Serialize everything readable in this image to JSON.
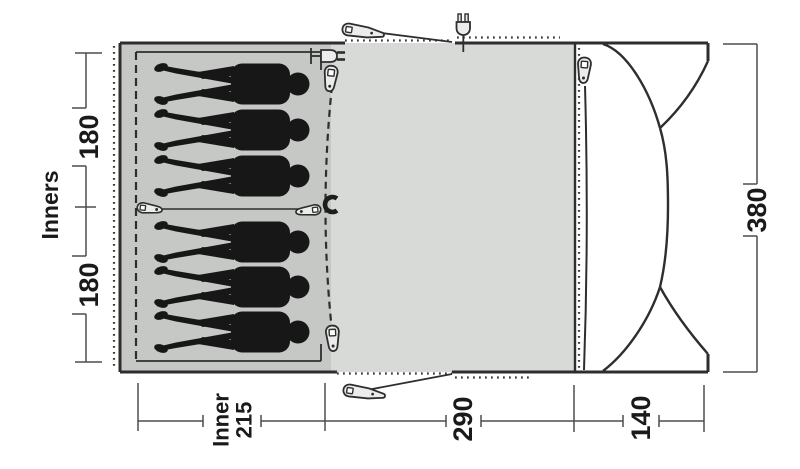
{
  "floor_plan": {
    "left_dimension": {
      "label": "Inners",
      "top_section": "180",
      "bottom_section": "180"
    },
    "right_dimension": {
      "total_depth": "380"
    },
    "bottom_dimension": {
      "inner_width_line1": "Inner",
      "inner_width_line2": "215",
      "living_width": "290",
      "porch_depth": "140"
    },
    "sleeping": {
      "positions": 6,
      "groups": [
        3,
        3
      ]
    },
    "icons": {
      "peg": "tent-peg",
      "plug": "power-plug",
      "cable_entry": "cable-entry-plug",
      "zipper": "zipper-pull",
      "toggle": "toggle-tie",
      "hook": "hook-clip"
    },
    "colors": {
      "living_area": "#d7dad6",
      "sleeping_area": "#c5c8c4",
      "silhouette": "#171717",
      "outline": "#2e2e2e",
      "dimension_line": "#4d4d4d",
      "background": "#ffffff"
    }
  }
}
